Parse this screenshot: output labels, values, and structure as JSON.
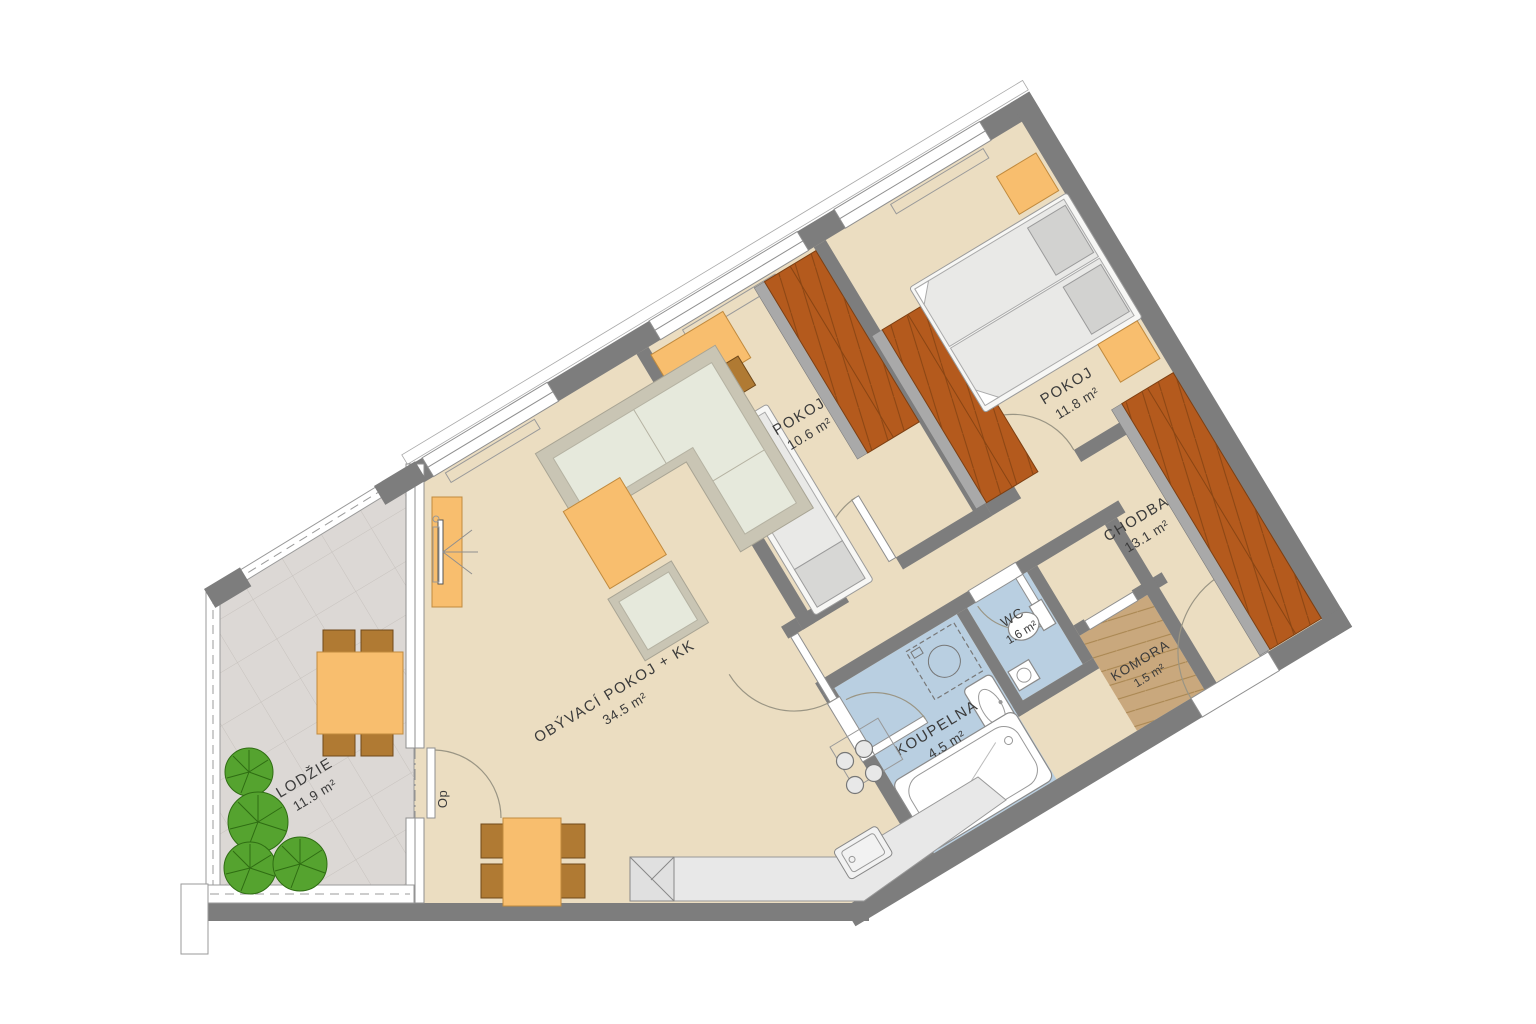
{
  "floorplan": {
    "door_label": "Op",
    "rooms": [
      {
        "name": "LODŽIE",
        "area": "11.9 m²"
      },
      {
        "name": "OBÝVACÍ POKOJ + KK",
        "area": "34.5 m²"
      },
      {
        "name": "POKOJ",
        "area": "10.6 m²"
      },
      {
        "name": "POKOJ",
        "area": "11.8 m²"
      },
      {
        "name": "CHODBA",
        "area": "13.1 m²"
      },
      {
        "name": "WC",
        "area": "1.6 m²"
      },
      {
        "name": "KOUPELNA",
        "area": "4.5 m²"
      },
      {
        "name": "KOMORA",
        "area": "1.5 m²"
      }
    ],
    "colors": {
      "wall": "#7d7d7d",
      "floor_main": "#ebddc1",
      "floor_loggia": "#dcd8d5",
      "floor_bathroom": "#b9cfe1",
      "floor_komora": "#c9a87d",
      "wardrobe": "#b45a1d",
      "furniture_orange": "#f8be6e",
      "furniture_wood": "#b07a33",
      "sofa_green": "#e6e9dc",
      "tree_green": "#55a32f",
      "counter_grey": "#e8e8e8"
    }
  }
}
